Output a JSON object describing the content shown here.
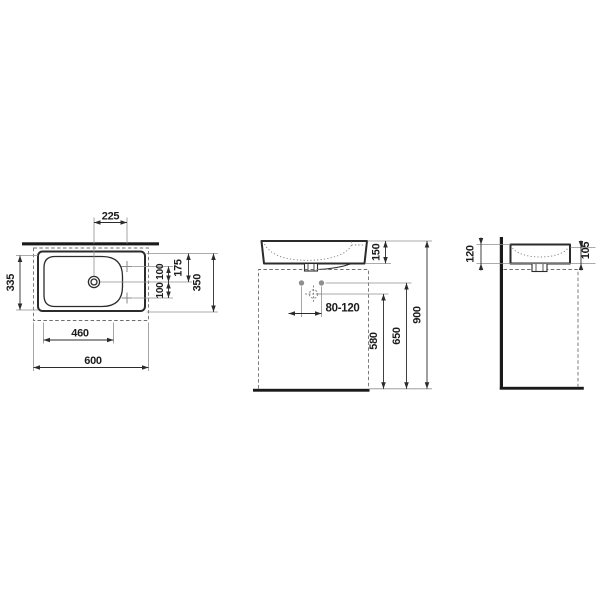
{
  "meta": {
    "drawing_type": "washbasin technical dimension drawing",
    "background_color": "#ffffff",
    "line_color": "#2b2b2b",
    "thin_line_color": "#8f8f8f",
    "text_color": "#1c1c1c"
  },
  "top_view": {
    "name": "top view",
    "dims": {
      "drain_to_tap_offset": "225",
      "inner_depth": "335",
      "tap_upper": "100",
      "tap_lower": "100",
      "edge_to_drain": "175",
      "total_depth": "350",
      "bowl_width": "460",
      "total_width": "600"
    }
  },
  "front_view": {
    "name": "front view",
    "dims": {
      "basin_height": "150",
      "fixing_range": "80-120",
      "siphon_height": "580",
      "fixing_height": "650",
      "total_height": "900"
    }
  },
  "side_view": {
    "name": "side view",
    "dims": {
      "rear_height": "120",
      "front_edge_height": "105"
    }
  }
}
